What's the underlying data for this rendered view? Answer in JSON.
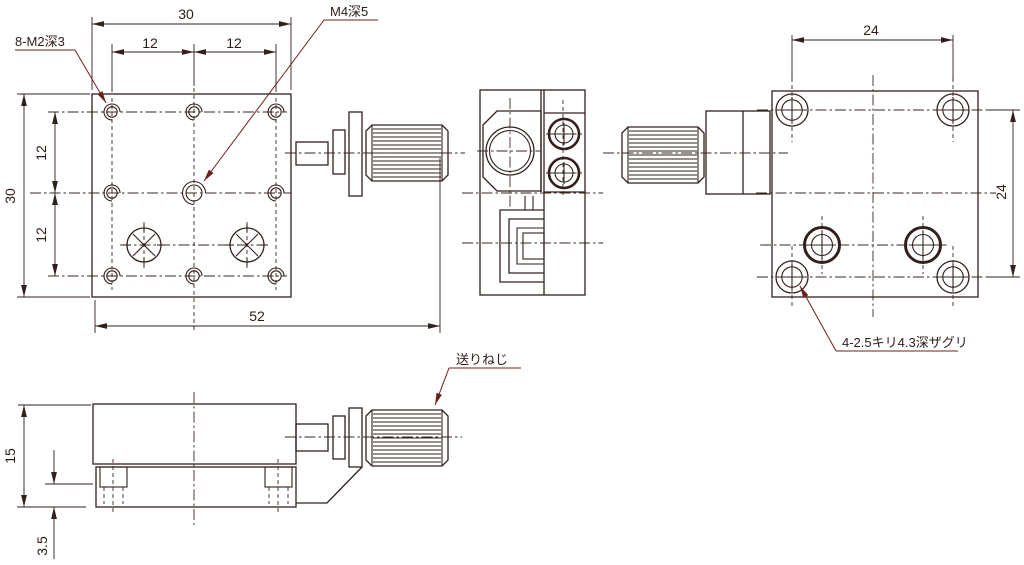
{
  "drawing": {
    "title": "stage-technical-drawing",
    "labels": {
      "tap_holes": "8-M2深3",
      "center_tap": "M4深5",
      "feed_screw": "送りねじ",
      "counterbore": "4-2.5キリ4.3深ザグリ"
    },
    "dims": {
      "top_width": "30",
      "top_half_left": "12",
      "top_half_right": "12",
      "left_height": "30",
      "left_half_upper": "12",
      "left_half_lower": "12",
      "overall_length": "52",
      "back_width": "24",
      "back_height": "24",
      "side_height": "15",
      "base_thickness": "3.5"
    },
    "colors": {
      "line": "#32201d",
      "leader": "#6b2018",
      "background": "#ffffff"
    }
  }
}
